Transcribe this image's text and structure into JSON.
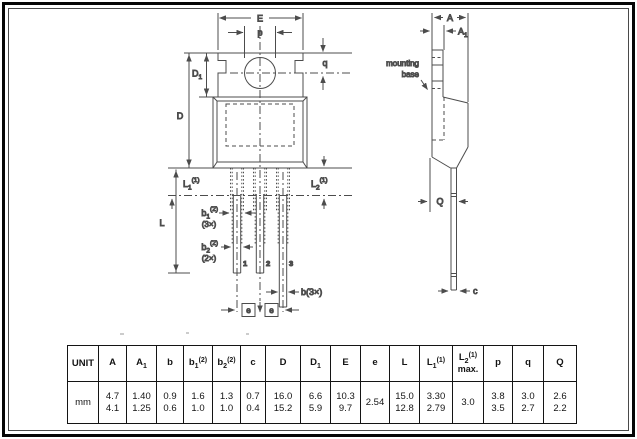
{
  "drawing": {
    "front_view": {
      "dim_E": "E",
      "dim_p": "p",
      "dim_q": "q",
      "dim_D": "D",
      "dim_D1": {
        "base": "D",
        "sub": "1"
      },
      "dim_L": "L",
      "dim_L1": {
        "base": "L",
        "sub": "1",
        "sup": "(1)"
      },
      "dim_L2": {
        "base": "L",
        "sub": "2",
        "sup": "(1)"
      },
      "dim_b1": {
        "base": "b",
        "sub": "1",
        "sup": "(2)",
        "count": "(3×)"
      },
      "dim_b2": {
        "base": "b",
        "sub": "2",
        "sup": "(2)",
        "count": "(2×)"
      },
      "dim_b": "b(3×)",
      "pitch_label_1": "e",
      "pitch_label_2": "e",
      "pin_1": "1",
      "pin_2": "2",
      "pin_3": "3"
    },
    "side_view": {
      "dim_A": "A",
      "dim_A1": {
        "base": "A",
        "sub": "1"
      },
      "mounting_base_line1": "mounting",
      "mounting_base_line2": "base",
      "dim_Q": "Q",
      "dim_c": "c"
    }
  },
  "table": {
    "unit_header": "UNIT",
    "unit_value": "mm",
    "columns": [
      {
        "base": "A",
        "sub": "",
        "sup": "",
        "note": "",
        "v1": "4.7",
        "v2": "4.1"
      },
      {
        "base": "A",
        "sub": "1",
        "sup": "",
        "note": "",
        "v1": "1.40",
        "v2": "1.25"
      },
      {
        "base": "b",
        "sub": "",
        "sup": "",
        "note": "",
        "v1": "0.9",
        "v2": "0.6"
      },
      {
        "base": "b",
        "sub": "1",
        "sup": "(2)",
        "note": "",
        "v1": "1.6",
        "v2": "1.0"
      },
      {
        "base": "b",
        "sub": "2",
        "sup": "(2)",
        "note": "",
        "v1": "1.3",
        "v2": "1.0"
      },
      {
        "base": "c",
        "sub": "",
        "sup": "",
        "note": "",
        "v1": "0.7",
        "v2": "0.4"
      },
      {
        "base": "D",
        "sub": "",
        "sup": "",
        "note": "",
        "v1": "16.0",
        "v2": "15.2"
      },
      {
        "base": "D",
        "sub": "1",
        "sup": "",
        "note": "",
        "v1": "6.6",
        "v2": "5.9"
      },
      {
        "base": "E",
        "sub": "",
        "sup": "",
        "note": "",
        "v1": "10.3",
        "v2": "9.7"
      },
      {
        "base": "e",
        "sub": "",
        "sup": "",
        "note": "",
        "v1": "2.54",
        "v2": ""
      },
      {
        "base": "L",
        "sub": "",
        "sup": "",
        "note": "",
        "v1": "15.0",
        "v2": "12.8"
      },
      {
        "base": "L",
        "sub": "1",
        "sup": "(1)",
        "note": "",
        "v1": "3.30",
        "v2": "2.79"
      },
      {
        "base": "L",
        "sub": "2",
        "sup": "(1)",
        "note": "max.",
        "v1": "3.0",
        "v2": ""
      },
      {
        "base": "p",
        "sub": "",
        "sup": "",
        "note": "",
        "v1": "3.8",
        "v2": "3.5"
      },
      {
        "base": "q",
        "sub": "",
        "sup": "",
        "note": "",
        "v1": "3.0",
        "v2": "2.7"
      },
      {
        "base": "Q",
        "sub": "",
        "sup": "",
        "note": "",
        "v1": "2.6",
        "v2": "2.2"
      }
    ]
  }
}
